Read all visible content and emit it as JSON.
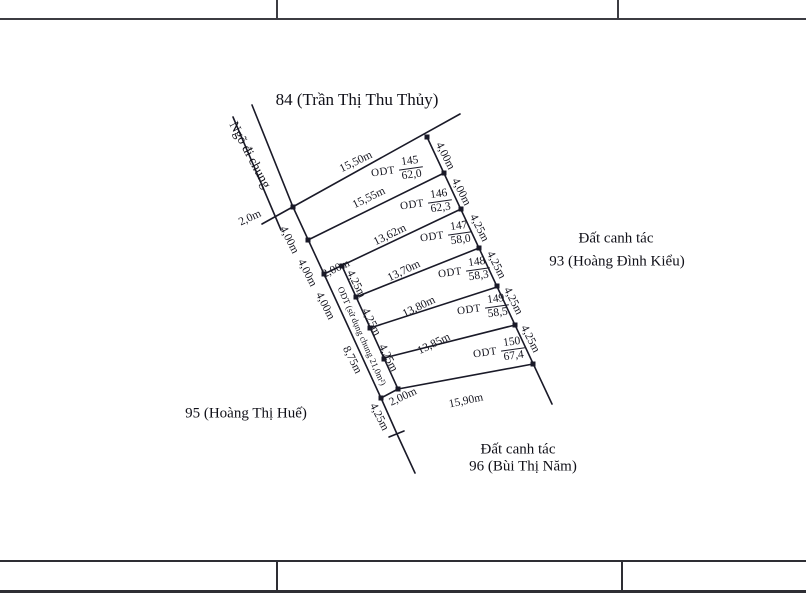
{
  "map": {
    "title": "84 (Trần Thị Thu Thủy)",
    "road": {
      "name": "Ngõ đi chung",
      "width": "2,0m"
    },
    "neighbors": {
      "right_top": "Đất canh tác",
      "right_bottom": "93 (Hoàng Đình Kiểu)",
      "left": "95 (Hoàng Thị Huế)",
      "bottom_top": "Đất canh tác",
      "bottom_bottom": "96 (Bùi Thị Năm)"
    },
    "parcels": [
      {
        "land_use": "ODT",
        "number": "145",
        "area": "62,0",
        "top_edge": "15,50m"
      },
      {
        "land_use": "ODT",
        "number": "146",
        "area": "62,3",
        "top_edge": "15,55m"
      },
      {
        "land_use": "ODT",
        "number": "147",
        "area": "58,0",
        "top_edge": "13,62m"
      },
      {
        "land_use": "ODT",
        "number": "148",
        "area": "58,3",
        "top_edge": "13,70m"
      },
      {
        "land_use": "ODT",
        "number": "149",
        "area": "58,5",
        "top_edge": "13,80m"
      },
      {
        "land_use": "ODT",
        "number": "150",
        "area": "67,4",
        "top_edge": "13,85m"
      }
    ],
    "bottom_edge": "15,90m",
    "right_side_dims": [
      "4,00m",
      "4,00m",
      "4,25m",
      "4,25m",
      "4,25m",
      "4,25m"
    ],
    "left_side_dims": [
      "4,00m",
      "4,00m",
      "4,00m",
      "8,75m",
      "4,25m"
    ],
    "strip": {
      "label": "ODT (sử dụng chung 21,0m²)",
      "top_width": "2,00m",
      "bottom_width": "2,00m",
      "side_dims": [
        "4,25m",
        "4,25m",
        "4,25m"
      ]
    }
  }
}
